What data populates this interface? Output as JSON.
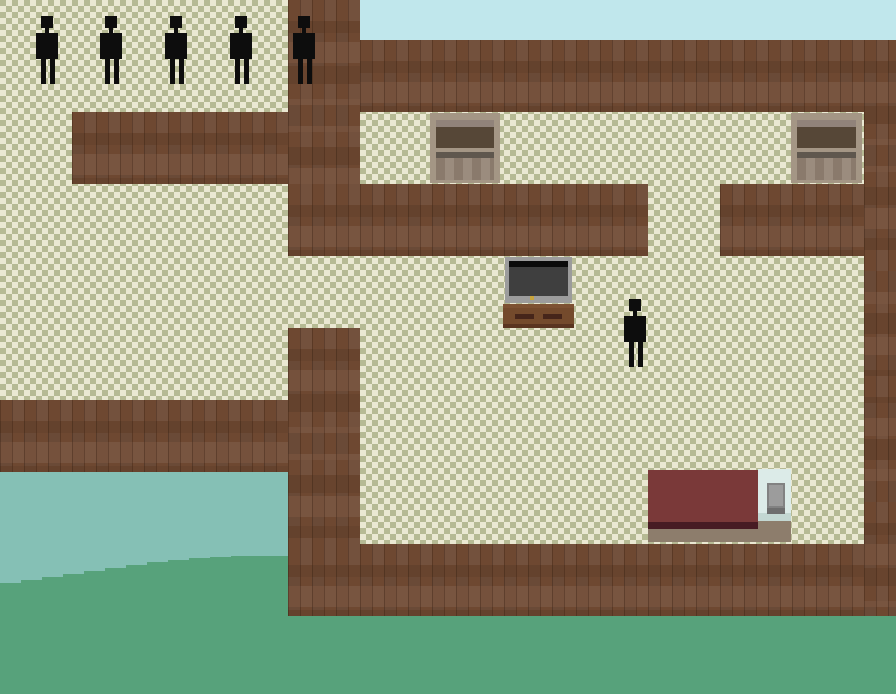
{
  "meta": {
    "app": "pixel-art-house-game",
    "view": "top-down interior with exterior water and grass",
    "viewport": {
      "width": 896,
      "height": 694
    }
  },
  "palette": {
    "floor_light": "#eae8d2",
    "floor_dark": "#b6ba94",
    "wall_brown": "#6e4831",
    "wall_plank_light": "#7c523a",
    "wall_plank_dark": "#5e3c29",
    "sky": "#c0e7ec",
    "water": "#85c0b5",
    "grass": "#57a27b",
    "character": "#0d0d0d",
    "cupboard_frame": "#a49685",
    "cupboard_panel": "#564737",
    "tv_frame": "#9c9c9c",
    "tv_screen": "#3f3f3f",
    "tv_lights": [
      "#b03232",
      "#3cb450",
      "#5abf9a",
      "#c8a43c"
    ],
    "stand_brown": "#744a2c",
    "bed_blanket": "#7a3939",
    "bed_blanket_edge": "#471b23",
    "bed_pillow_panel": "#dcebe8",
    "bed_pillow": "#9c9c9c",
    "bed_base": "#8d7d6c"
  },
  "terrain": [
    {
      "name": "floor-base",
      "cls": "floor",
      "x": 0,
      "y": 0,
      "w": 896,
      "h": 616
    },
    {
      "name": "wall-top-band",
      "cls": "wall",
      "x": 360,
      "y": 40,
      "w": 536,
      "h": 72
    },
    {
      "name": "wall-npc-room-column",
      "cls": "wall",
      "x": 288,
      "y": 0,
      "w": 72,
      "h": 256
    },
    {
      "name": "wall-below-npc-room",
      "cls": "wall",
      "x": 72,
      "y": 112,
      "w": 216,
      "h": 72
    },
    {
      "name": "wall-mid-left",
      "cls": "wall",
      "x": 288,
      "y": 184,
      "w": 360,
      "h": 72
    },
    {
      "name": "wall-mid-right",
      "cls": "wall",
      "x": 720,
      "y": 184,
      "w": 144,
      "h": 72
    },
    {
      "name": "wall-right-column",
      "cls": "wall",
      "x": 864,
      "y": 40,
      "w": 32,
      "h": 576
    },
    {
      "name": "wall-lower-left",
      "cls": "wall",
      "x": 0,
      "y": 400,
      "w": 360,
      "h": 72
    },
    {
      "name": "wall-lower-column",
      "cls": "wall",
      "x": 288,
      "y": 328,
      "w": 72,
      "h": 288
    },
    {
      "name": "wall-bottom-band",
      "cls": "wall",
      "x": 288,
      "y": 544,
      "w": 576,
      "h": 72
    },
    {
      "name": "sky",
      "cls": "sky",
      "x": 360,
      "y": 0,
      "w": 536,
      "h": 40
    },
    {
      "name": "water",
      "cls": "water",
      "x": 0,
      "y": 472,
      "w": 288,
      "h": 144
    },
    {
      "name": "grass-hill",
      "cls": "grass",
      "x": 0,
      "y": 472,
      "w": 288,
      "h": 144,
      "clip": [
        [
          0,
          111
        ],
        [
          21,
          111
        ],
        [
          21,
          108
        ],
        [
          42,
          108
        ],
        [
          42,
          105
        ],
        [
          63,
          105
        ],
        [
          63,
          102
        ],
        [
          84,
          102
        ],
        [
          84,
          99
        ],
        [
          105,
          99
        ],
        [
          105,
          96
        ],
        [
          126,
          96
        ],
        [
          126,
          93
        ],
        [
          147,
          93
        ],
        [
          147,
          90
        ],
        [
          168,
          90
        ],
        [
          168,
          88
        ],
        [
          189,
          88
        ],
        [
          189,
          86
        ],
        [
          210,
          86
        ],
        [
          210,
          85
        ],
        [
          231,
          85
        ],
        [
          231,
          84
        ],
        [
          288,
          84
        ],
        [
          288,
          144
        ],
        [
          0,
          144
        ]
      ]
    },
    {
      "name": "grass-field",
      "cls": "grass",
      "x": 0,
      "y": 616,
      "w": 896,
      "h": 78
    }
  ],
  "furniture": [
    {
      "name": "cupboard-left",
      "type": "cupboard",
      "x": 430,
      "y": 113,
      "w": 70,
      "h": 70
    },
    {
      "name": "cupboard-right",
      "type": "cupboard",
      "x": 791,
      "y": 113,
      "w": 71,
      "h": 70
    },
    {
      "name": "tv",
      "type": "tv",
      "x": 505,
      "y": 257,
      "w": 67,
      "h": 46
    },
    {
      "name": "tv-stand",
      "type": "stand",
      "x": 503,
      "y": 304,
      "w": 71,
      "h": 24
    },
    {
      "name": "bed",
      "type": "bed",
      "x": 648,
      "y": 469,
      "w": 143,
      "h": 74
    }
  ],
  "characters": {
    "sprite": {
      "w": 22,
      "h": 68
    },
    "npcs": [
      {
        "x": 36,
        "y": 16
      },
      {
        "x": 100,
        "y": 16
      },
      {
        "x": 165,
        "y": 16
      },
      {
        "x": 230,
        "y": 16
      },
      {
        "x": 293,
        "y": 16
      }
    ],
    "player": {
      "x": 624,
      "y": 299
    }
  }
}
